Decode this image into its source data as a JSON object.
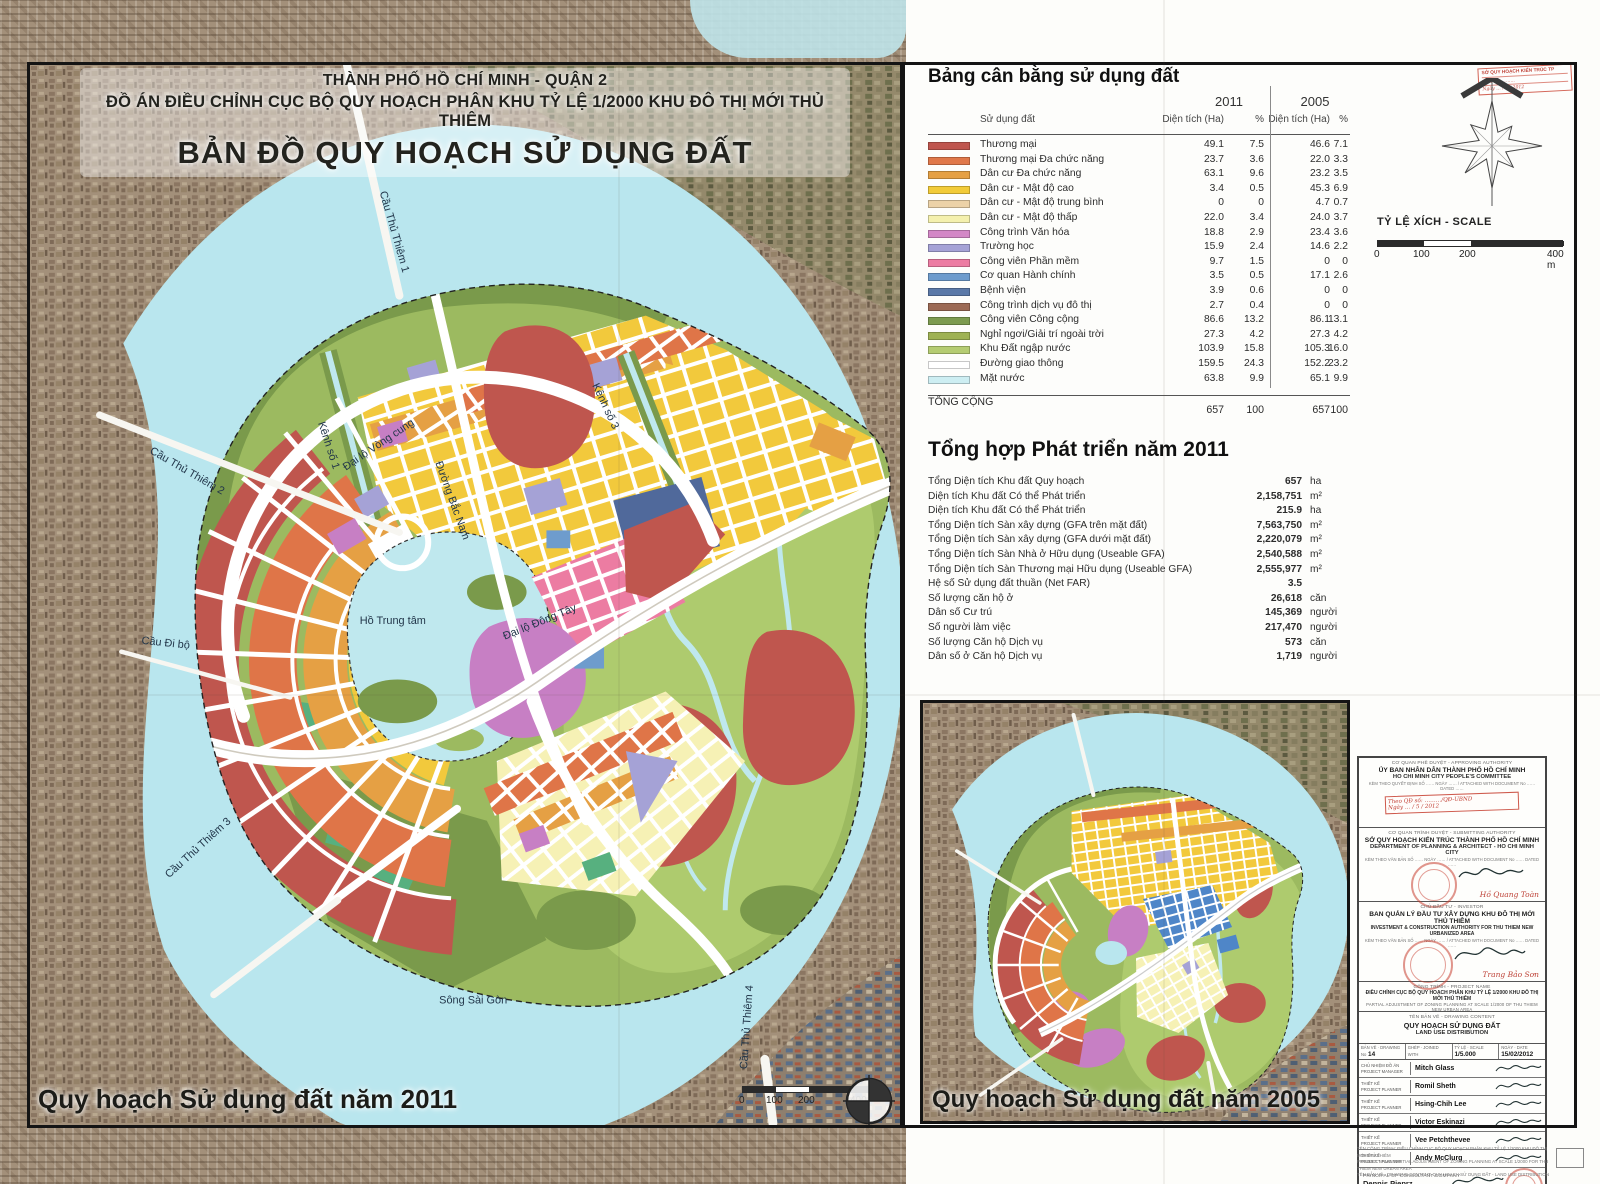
{
  "title": {
    "line1": "THÀNH PHỐ HỒ CHÍ MINH - QUẬN 2",
    "line2": "ĐỒ ÁN ĐIỀU CHỈNH CỤC BỘ QUY HOẠCH PHÂN KHU TỶ LỆ 1/2000 KHU ĐÔ THỊ MỚI THỦ THIÊM",
    "line3": "BẢN ĐỒ QUY HOẠCH SỬ DỤNG ĐẤT"
  },
  "land_use_table": {
    "heading": "Bảng cân bằng sử dụng đất",
    "year_2011": "2011",
    "year_2005": "2005",
    "col_land": "Sử dụng đất",
    "col_area": "Diện tích (Ha)",
    "col_pct": "%",
    "rows": [
      {
        "label": "Thương mại",
        "color": "#bf564e",
        "area_2011": "49.1",
        "pct_2011": "7.5",
        "area_2005": "46.6",
        "pct_2005": "7.1"
      },
      {
        "label": "Thương mại Đa chức năng",
        "color": "#e0784a",
        "area_2011": "23.7",
        "pct_2011": "3.6",
        "area_2005": "22.0",
        "pct_2005": "3.3"
      },
      {
        "label": "Dân cư Đa chức năng",
        "color": "#e5a044",
        "area_2011": "63.1",
        "pct_2011": "9.6",
        "area_2005": "23.2",
        "pct_2005": "3.5"
      },
      {
        "label": "Dân cư - Mật độ cao",
        "color": "#f2cb38",
        "area_2011": "3.4",
        "pct_2011": "0.5",
        "area_2005": "45.3",
        "pct_2005": "6.9"
      },
      {
        "label": "Dân cư - Mật độ trung bình",
        "color": "#ecd2a8",
        "area_2011": "0",
        "pct_2011": "0",
        "area_2005": "4.7",
        "pct_2005": "0.7"
      },
      {
        "label": "Dân cư - Mật độ thấp",
        "color": "#f4f0ad",
        "area_2011": "22.0",
        "pct_2011": "3.4",
        "area_2005": "24.0",
        "pct_2005": "3.7"
      },
      {
        "label": "Công trình Văn hóa",
        "color": "#d387c6",
        "area_2011": "18.8",
        "pct_2011": "2.9",
        "area_2005": "23.4",
        "pct_2005": "3.6"
      },
      {
        "label": "Trường học",
        "color": "#a5a2d6",
        "area_2011": "15.9",
        "pct_2011": "2.4",
        "area_2005": "14.6",
        "pct_2005": "2.2"
      },
      {
        "label": "Công viên Phần mềm",
        "color": "#ec7ca2",
        "area_2011": "9.7",
        "pct_2011": "1.5",
        "area_2005": "0",
        "pct_2005": "0"
      },
      {
        "label": "Cơ quan Hành chính",
        "color": "#6e9ccd",
        "area_2011": "3.5",
        "pct_2011": "0.5",
        "area_2005": "17.1",
        "pct_2005": "2.6"
      },
      {
        "label": "Bệnh viện",
        "color": "#5b79a8",
        "area_2011": "3.9",
        "pct_2011": "0.6",
        "area_2005": "0",
        "pct_2005": "0"
      },
      {
        "label": "Công trình dịch vụ đô thị",
        "color": "#9c6a55",
        "area_2011": "2.7",
        "pct_2011": "0.4",
        "area_2005": "0",
        "pct_2005": "0"
      },
      {
        "label": "Công viên Công cộng",
        "color": "#7d9b50",
        "area_2011": "86.6",
        "pct_2011": "13.2",
        "area_2005": "86.1",
        "pct_2005": "13.1"
      },
      {
        "label": "Nghỉ ngơi/Giải trí ngoài trời",
        "color": "#9fb254",
        "area_2011": "27.3",
        "pct_2011": "4.2",
        "area_2005": "27.3",
        "pct_2005": "4.2"
      },
      {
        "label": "Khu Đất ngập nước",
        "color": "#b5cc72",
        "area_2011": "103.9",
        "pct_2011": "15.8",
        "area_2005": "105.3",
        "pct_2005": "16.0"
      },
      {
        "label": "Đường giao thông",
        "color": "#ffffff",
        "area_2011": "159.5",
        "pct_2011": "24.3",
        "area_2005": "152.2",
        "pct_2005": "23.2"
      },
      {
        "label": "Mặt nước",
        "color": "#cdeef2",
        "area_2011": "63.8",
        "pct_2011": "9.9",
        "area_2005": "65.1",
        "pct_2005": "9.9"
      }
    ],
    "total_label": "TỔNG CỘNG",
    "total_area_2011": "657",
    "total_pct_2011": "100",
    "total_area_2005": "657",
    "total_pct_2005": "100"
  },
  "development_summary": {
    "heading": "Tổng hợp Phát triển năm 2011",
    "rows": [
      {
        "label": "Tổng Diện tích Khu đất Quy hoạch",
        "value": "657",
        "unit": "ha"
      },
      {
        "label": "Diện tích Khu đất Có thể Phát triển",
        "value": "2,158,751",
        "unit": "m²"
      },
      {
        "label": "Diện tích Khu đất Có thể Phát triển",
        "value": "215.9",
        "unit": "ha"
      },
      {
        "label": "Tổng Diện tích Sàn xây dựng (GFA trên mặt đất)",
        "value": "7,563,750",
        "unit": "m²"
      },
      {
        "label": "Tổng Diện tích Sàn xây dựng (GFA dưới mặt đất)",
        "value": "2,220,079",
        "unit": "m²"
      },
      {
        "label": "Tổng Diện tích Sàn Nhà ở Hữu dụng (Useable GFA)",
        "value": "2,540,588",
        "unit": "m²"
      },
      {
        "label": "Tổng Diện tích Sàn Thương mại Hữu dụng (Useable GFA)",
        "value": "2,555,977",
        "unit": "m²"
      },
      {
        "label": "Hệ số Sử dụng đất thuần (Net FAR)",
        "value": "3.5",
        "unit": ""
      },
      {
        "label": "Số lượng căn hộ ở",
        "value": "26,618",
        "unit": "căn"
      },
      {
        "label": "Dân số Cư trú",
        "value": "145,369",
        "unit": "người"
      },
      {
        "label": "Số người làm việc",
        "value": "217,470",
        "unit": "người"
      },
      {
        "label": "Số lượng Căn hộ Dịch vụ",
        "value": "573",
        "unit": "căn"
      },
      {
        "label": "Dân số ở Căn hộ Dịch vụ",
        "value": "1,719",
        "unit": "người"
      }
    ]
  },
  "map_labels": {
    "ctt1": "Cầu Thủ Thiêm 1",
    "ctt2": "Cầu Thủ Thiêm 2",
    "ctt3": "Cầu Thủ Thiêm 3",
    "ctt4": "Cầu Thủ Thiêm 4",
    "cdb": "Cầu Đi bộ",
    "k1": "Kênh số 1",
    "k3": "Kênh số 3",
    "vc": "Đại lộ Vòng cung",
    "bn": "Đường Bắc Nam",
    "dt": "Đại lộ Đông Tây",
    "ht": "Hồ Trung tâm",
    "ssg": "Sông Sài Gòn"
  },
  "map_2011_caption": "Quy hoạch Sử dụng đất năm 2011",
  "map_2005_caption": "Quy hoạch Sử dụng đất  năm 2005",
  "scale": {
    "label": "TỶ LỆ XÍCH - SCALE",
    "t0": "0",
    "t1": "100",
    "t2": "200",
    "t3": "400 m"
  },
  "corner_stamp": {
    "l1": "SỞ QUY HOẠCH KIẾN TRÚC TP",
    "l2": "ĐẾN   Số: ………",
    "l3": "Ngày … / 5 / 2012"
  },
  "title_block": {
    "approving": {
      "heading": "CƠ QUAN PHÊ DUYỆT - APPROVING AUTHORITY",
      "org_vn": "ỦY BAN NHÂN DÂN THÀNH PHỐ HỒ CHÍ MINH",
      "org_en": "HO CHI MINH CITY PEOPLE'S COMMITTEE",
      "attach": "KÈM THEO QUYẾT ĐỊNH SỐ …… NGÀY …… / ATTACHED WITH DOCUMENT No …… DATED ……",
      "stamp_line1": "Theo QĐ số: ………/QĐ-UBND",
      "stamp_line2": "Ngày … / 5 / 2012"
    },
    "submitting": {
      "heading": "CƠ QUAN TRÌNH DUYỆT - SUBMITTING AUTHORITY",
      "org_vn": "SỞ QUY HOẠCH KIẾN TRÚC THÀNH PHỐ HỒ CHÍ MINH",
      "org_en": "DEPARTMENT OF PLANNING & ARCHITECT - HO CHI MINH CITY",
      "attach": "KÈM THEO VĂN BẢN SỐ …… NGÀY …… / ATTACHED WITH DOCUMENT No …… DATED ……",
      "signer": "Hồ Quang Toàn"
    },
    "investor": {
      "heading": "CHỦ ĐẦU TƯ - INVESTOR",
      "org_vn": "BAN QUẢN LÝ ĐẦU TƯ XÂY DỰNG KHU ĐÔ THỊ MỚI THỦ THIÊM",
      "org_en": "INVESTMENT & CONSTRUCTION AUTHORITY FOR THU THIEM NEW URBANIZED AREA",
      "attach": "KÈM THEO VĂN BẢN SỐ …… NGÀY …… / ATTACHED WITH DOCUMENT No …… DATED ……",
      "signer": "Trang Bảo Sơn"
    },
    "project": {
      "heading": "CÔNG TRÌNH - PROJECT NAME",
      "line_vn": "ĐIỀU CHỈNH CỤC BỘ QUY HOẠCH PHÂN KHU TỶ LỆ 1/2000 KHU ĐÔ THỊ MỚI THỦ THIÊM",
      "line_en": "PARTIAL ADJUSTMENT OF ZONING PLANNING AT SCALE 1/2000 OF THU THIEM NEW URBAN AREA"
    },
    "drawing": {
      "heading": "TÊN BẢN VẼ - DRAWING CONTENT",
      "line_vn": "QUY HOẠCH SỬ DỤNG ĐẤT",
      "line_en": "LAND USE DISTRIBUTION"
    },
    "info": {
      "no_vn": "BẢN VẼ",
      "no_en": "DRAWING No",
      "no_value": "14",
      "joined_vn": "GHÉP",
      "joined_en": "JOINED WITH",
      "joined_value": "",
      "scale_vn": "TỶ LỆ",
      "scale_en": "SCALE",
      "scale_value": "1/5.000",
      "date_vn": "NGÀY",
      "date_en": "DATE",
      "date_value": "15/02/2012"
    },
    "staff": [
      {
        "role_vn": "CHỦ NHIỆM ĐỒ ÁN",
        "role_en": "PROJECT MANAGER",
        "name": "Mitch Glass"
      },
      {
        "role_vn": "THIẾT KẾ",
        "role_en": "PROJECT PLANNER",
        "name": "Romil Sheth"
      },
      {
        "role_vn": "THIẾT KẾ",
        "role_en": "PROJECT PLANNER",
        "name": "Hsing-Chih Lee"
      },
      {
        "role_vn": "THIẾT KẾ",
        "role_en": "PROJECT PLANNER",
        "name": "Victor Eskinazi"
      },
      {
        "role_vn": "THIẾT KẾ",
        "role_en": "PROJECT PLANNER",
        "name": "Vee Petchthevee"
      },
      {
        "role_vn": "THIẾT KẾ",
        "role_en": "PROJECT PLANNER",
        "name": "Andy McClurg"
      }
    ],
    "principal": {
      "label": "PRINCIPAL OF CONSULTANT COMPANY",
      "name": "Dennis Pieprz"
    },
    "company": {
      "logo": "S A S A K I",
      "name_vn": "CÔNG TY SASAKI",
      "name_en": "SASAKI ASSOCIATES INC.",
      "address": "BOSTON, MASSACHUSETTS, USA"
    },
    "fineprint": {
      "l1": "TÊN CÔNG TRÌNH: ĐIỀU CHỈNH CỤC BỘ QUY HOẠCH PHÂN KHU TỶ LỆ 1/2000 KHU ĐÔ THỊ MỚI THỦ THIÊM",
      "l2": "PROJECT NAME: PARTIAL ADJUSTMENT OF ZONING PLANNING AT SCALE 1/2000 FOR THU THIEM NEW URBAN AREA",
      "l3": "TÊN BẢN VẼ - DRAWING CONTENT: QUY HOẠCH SỬ DỤNG ĐẤT - LAND USE DISTRIBUTION"
    }
  },
  "palette": {
    "water": "#b9e6ee",
    "park": "#7d9b4e",
    "wetland": "#aecb6e",
    "stamp_red": "#c23e2d"
  }
}
